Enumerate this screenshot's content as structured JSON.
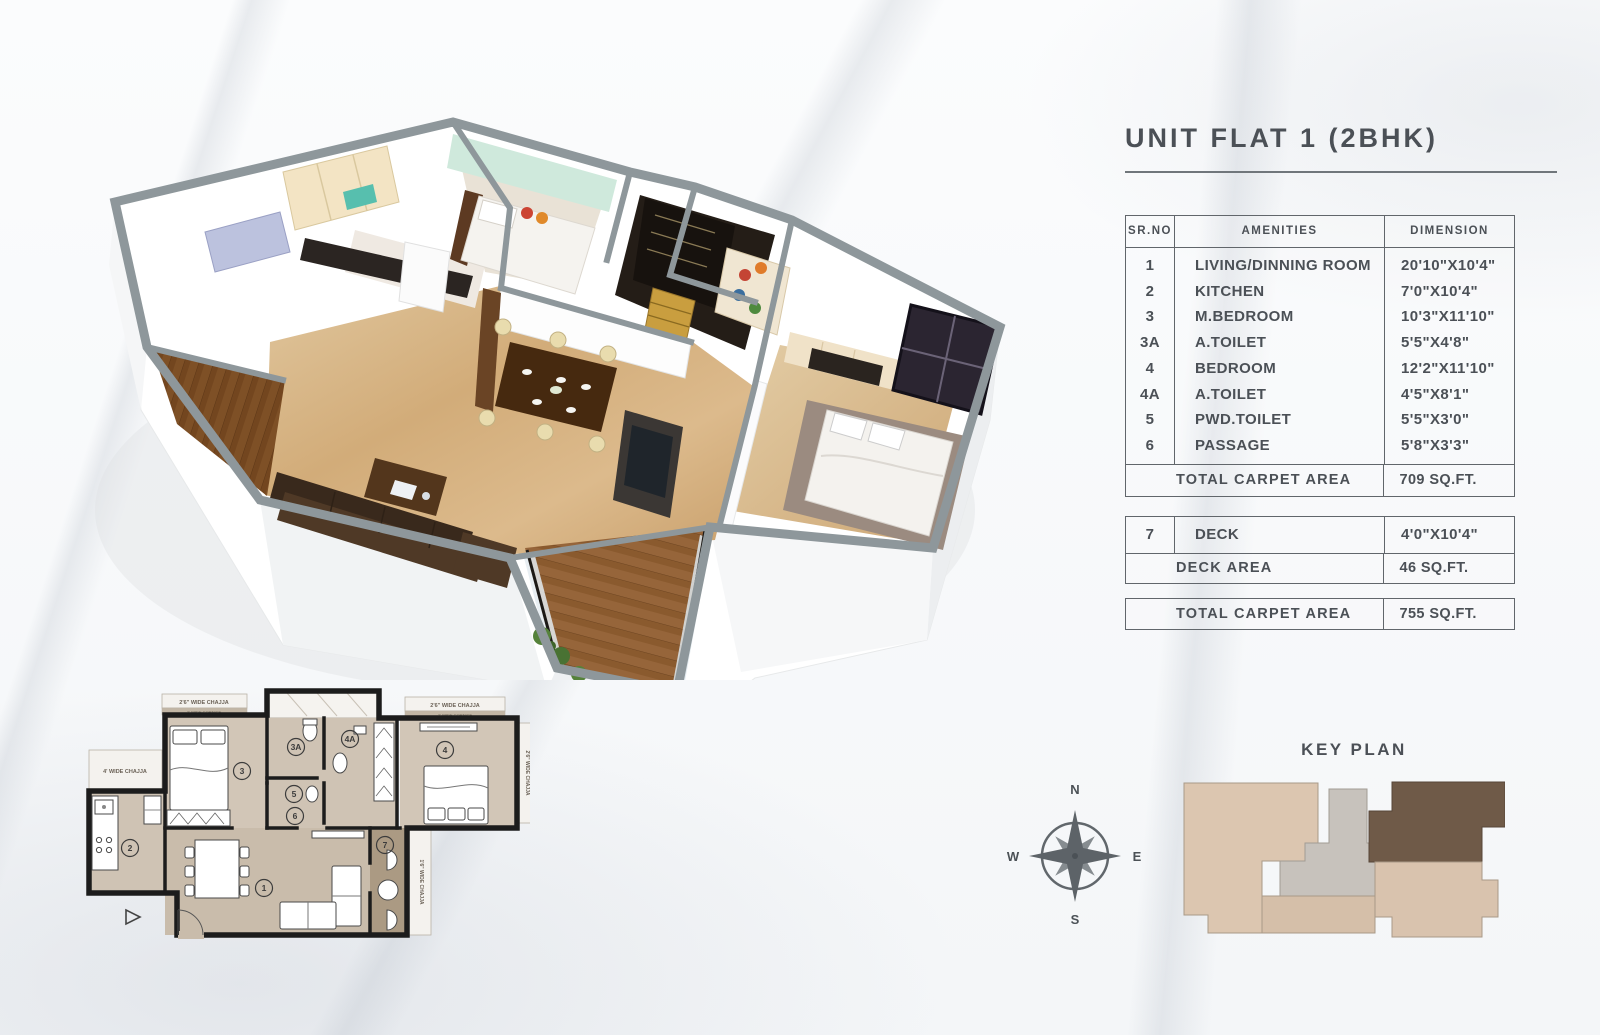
{
  "page_title": "UNIT FLAT 1 (2BHK)",
  "carpet_table": {
    "headers": {
      "sr": "SR.NO",
      "amenities": "AMENITIES",
      "dimension": "DIMENSION"
    },
    "rows": [
      {
        "sr": "1",
        "amenities": "LIVING/DINNING ROOM",
        "dimension": "20'10\"X10'4\""
      },
      {
        "sr": "2",
        "amenities": "KITCHEN",
        "dimension": "7'0\"X10'4\""
      },
      {
        "sr": "3",
        "amenities": "M.BEDROOM",
        "dimension": "10'3\"X11'10\""
      },
      {
        "sr": "3A",
        "amenities": "A.TOILET",
        "dimension": "5'5\"X4'8\""
      },
      {
        "sr": "4",
        "amenities": "BEDROOM",
        "dimension": "12'2\"X11'10\""
      },
      {
        "sr": "4A",
        "amenities": "A.TOILET",
        "dimension": "4'5\"X8'1\""
      },
      {
        "sr": "5",
        "amenities": "PWD.TOILET",
        "dimension": "5'5\"X3'0\""
      },
      {
        "sr": "6",
        "amenities": "PASSAGE",
        "dimension": "5'8\"X3'3\""
      }
    ],
    "total": {
      "label": "TOTAL CARPET AREA",
      "value": "709 SQ.FT."
    }
  },
  "deck_table": {
    "row": {
      "sr": "7",
      "amenities": "DECK",
      "dimension": "4'0\"X10'4\""
    },
    "total": {
      "label": "DECK AREA",
      "value": "46 SQ.FT."
    }
  },
  "grand_total": {
    "label": "TOTAL CARPET AREA",
    "value": "755 SQ.FT."
  },
  "key_plan": {
    "title": "KEY PLAN",
    "compass": {
      "north": "N",
      "east": "E",
      "south": "S",
      "west": "W"
    }
  },
  "plan_2d": {
    "rooms": {
      "living": "1",
      "kitchen": "2",
      "master_bedroom": "3",
      "master_toilet": "3A",
      "bedroom": "4",
      "attached_toilet": "4A",
      "powder_toilet": "5",
      "passage": "6",
      "deck": "7"
    },
    "labels": {
      "chajja_top_left": "2'6\" WIDE CHAJJA",
      "chajja_top_right": "2'6\" WIDE CHAJJA",
      "chajja_left": "4' WIDE CHAJJA",
      "chajja_right": "2'6\" WIDE CHAJJA",
      "chajja_deck": "1'6\" WIDE CHAJJA",
      "cornice_left": "2' WIDE CORNICE",
      "cornice_right": "2' WIDE CORNICE"
    }
  },
  "colors": {
    "text": "#4b5056",
    "table_border": "#61666b",
    "keyplan_highlight": "#6f5a48",
    "keyplan_light": "#dcc6b0",
    "keyplan_gray": "#c7c2bc",
    "floor_marble": "#d6b286",
    "deck_wood": "#96653a"
  }
}
